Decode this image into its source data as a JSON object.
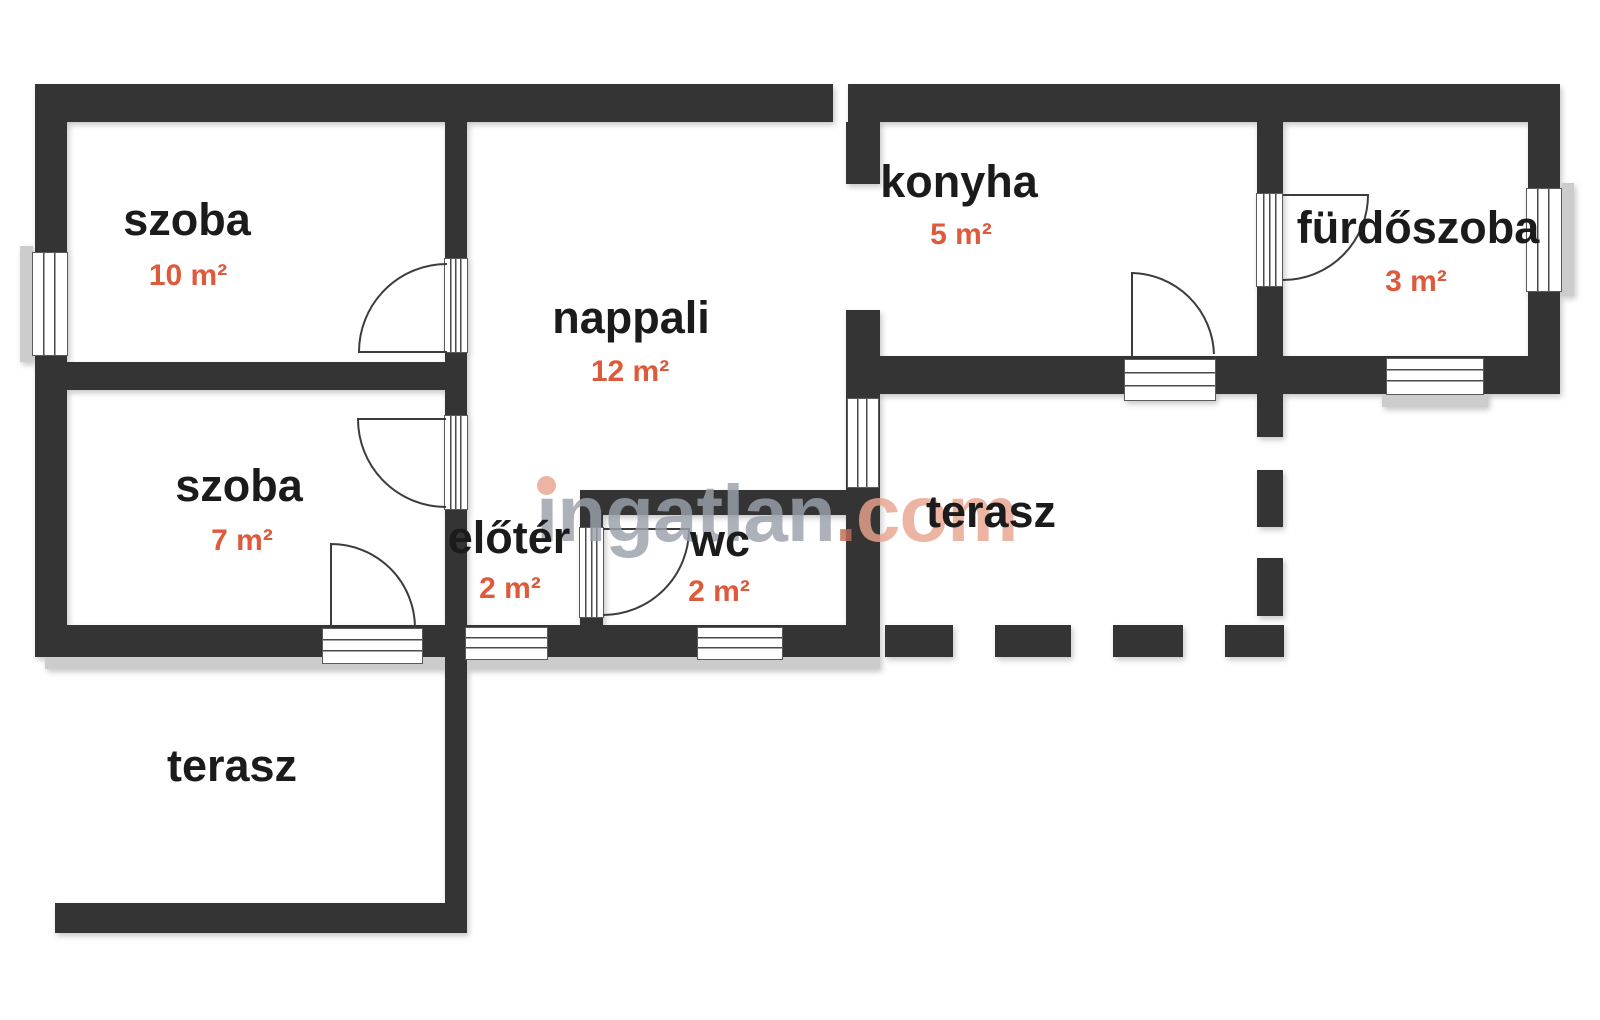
{
  "colors": {
    "wall": "#343434",
    "accent": "#de5a3c",
    "label": "#1b1b1b",
    "wm-gray": "#9aa1ab",
    "wm-salmon": "#e9a48e",
    "wm-dot": "#bf6c55"
  },
  "watermark": {
    "name": "ingatlan",
    "dot": ".",
    "tld": "com"
  },
  "rooms": [
    {
      "id": "szoba-10",
      "name": "szoba",
      "area": "10 m²"
    },
    {
      "id": "nappali",
      "name": "nappali",
      "area": "12 m²"
    },
    {
      "id": "konyha",
      "name": "konyha",
      "area": "5 m²"
    },
    {
      "id": "furdoszoba",
      "name": "fürdőszoba",
      "area": "3 m²"
    },
    {
      "id": "szoba-7",
      "name": "szoba",
      "area": "7 m²"
    },
    {
      "id": "eloter",
      "name": "előtér",
      "area": "2 m²"
    },
    {
      "id": "wc",
      "name": "wc",
      "area": "2 m²"
    },
    {
      "id": "terasz-right",
      "name": "terasz"
    },
    {
      "id": "terasz-left",
      "name": "terasz"
    }
  ]
}
